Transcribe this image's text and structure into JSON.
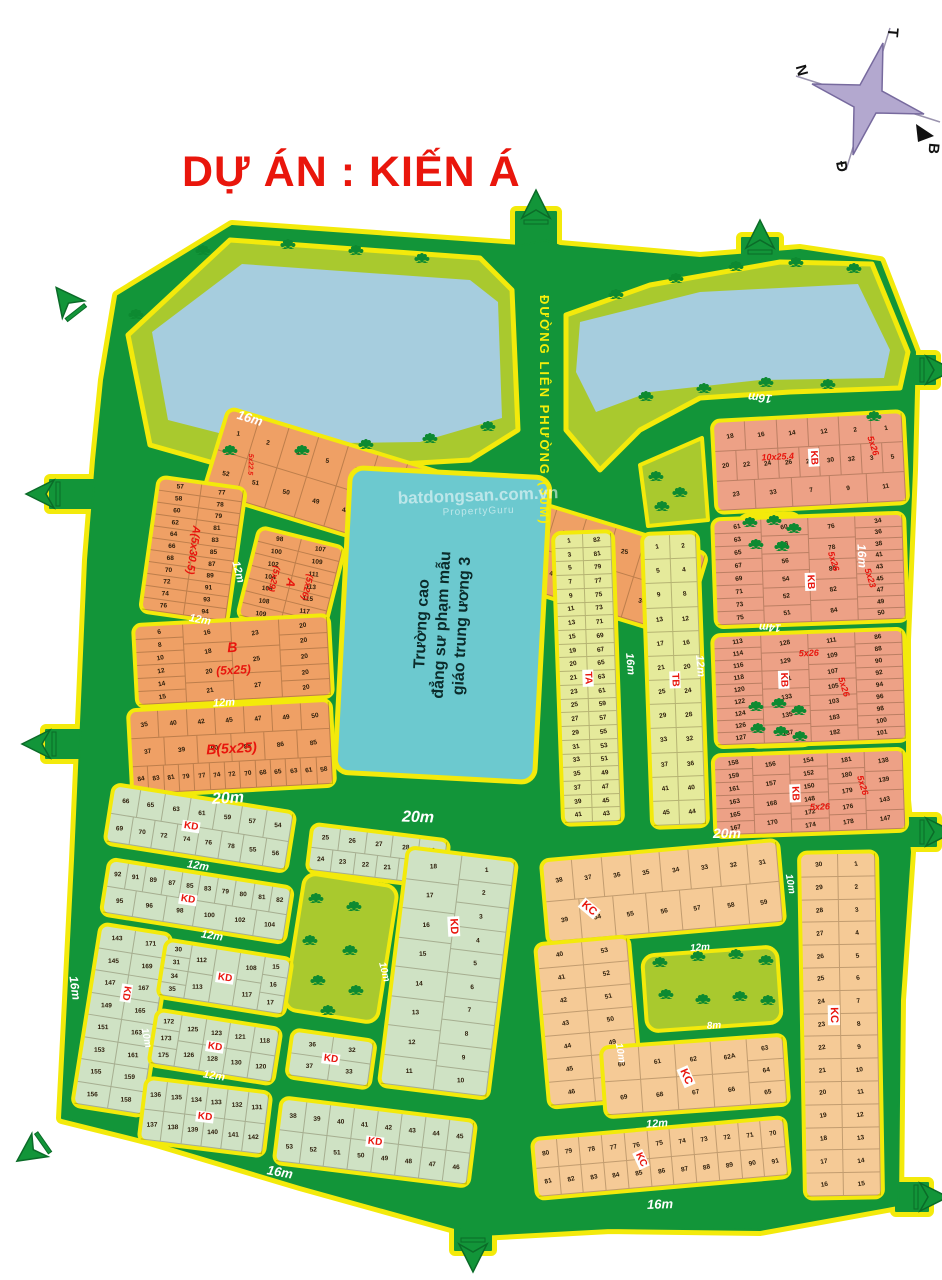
{
  "title": "DỰ ÁN : KIẾN Á",
  "compass": {
    "west": "T",
    "south": "N",
    "north": "B",
    "east": "Đ"
  },
  "main_road_label": "ĐƯỜNG LIÊN PHƯỜNG (30M)",
  "college": {
    "line1": "Trường cao",
    "line2": "đẳng sư phạm mẫu",
    "line3": "giáo trung ương 3"
  },
  "watermark": {
    "line1": "batdongsan.com.vn",
    "line2": "PropertyGuru"
  },
  "road_labels": [
    "16m",
    "16m",
    "12m",
    "12m",
    "12m",
    "20m",
    "20m",
    "20m",
    "16m",
    "16m",
    "14m",
    "12m",
    "16m",
    "12m",
    "12m",
    "12m",
    "10m",
    "10m",
    "16m",
    "16m",
    "12m",
    "8m",
    "10m",
    "12m",
    "16m",
    "10m"
  ],
  "blocks": {
    "a22": {
      "labels": [
        "A(5x22)",
        "5x22.5"
      ],
      "rows": [
        [
          "1",
          "2",
          "3",
          "5",
          "7",
          "9",
          "11",
          "13",
          "15",
          "17",
          "19",
          "21",
          "23",
          "25",
          "27",
          "29"
        ],
        [
          "52",
          "51",
          "50",
          "49",
          "48",
          "47",
          "46",
          "45",
          "44",
          "43",
          "42",
          "41",
          "33",
          "31",
          "30",
          "28"
        ]
      ]
    },
    "a30": {
      "labels": [
        "A(5x30.5)"
      ],
      "cols": [
        [
          "57",
          "58",
          "60",
          "62",
          "64",
          "66",
          "68",
          "70",
          "72",
          "74",
          "76"
        ],
        [
          "77",
          "78",
          "79",
          "81",
          "83",
          "85",
          "87",
          "89",
          "91",
          "93",
          "94"
        ]
      ]
    },
    "a29": {
      "labels": [
        "(5x29)",
        "A",
        "(5x26)"
      ],
      "cols": [
        [
          "98",
          "100",
          "102",
          "104",
          "106",
          "108",
          "109"
        ],
        [
          "107",
          "109",
          "111",
          "113",
          "115",
          "117",
          "118"
        ]
      ]
    },
    "b1": {
      "labels": [
        "B",
        "(5x25)"
      ],
      "cols": [
        [
          "6",
          "8",
          "10",
          "12",
          "14",
          "15"
        ],
        [
          "16",
          "18",
          "20",
          "21"
        ],
        [
          "23",
          "25",
          "27"
        ],
        [
          "20",
          "20",
          "20",
          "20",
          "20"
        ]
      ]
    },
    "b2": {
      "labels": [
        "B(5x25)"
      ],
      "rows": [
        [
          "35",
          "40",
          "42",
          "45",
          "47",
          "49",
          "50"
        ],
        [
          "37",
          "39",
          "90",
          "88",
          "86",
          "85"
        ],
        [
          "84",
          "83",
          "81",
          "79",
          "77",
          "74",
          "72",
          "70",
          "68",
          "65",
          "63",
          "61",
          "58"
        ]
      ]
    },
    "kd1": {
      "labels": [
        "KD"
      ],
      "rows": [
        [
          "66",
          "65",
          "63",
          "61",
          "59",
          "57",
          "54"
        ],
        [
          "69",
          "70",
          "72",
          "74",
          "76",
          "78",
          "55",
          "56"
        ]
      ]
    },
    "kd2": {
      "labels": [
        "KD"
      ],
      "rows": [
        [
          "92",
          "91",
          "89",
          "87",
          "85",
          "83",
          "79",
          "80",
          "81",
          "82"
        ],
        [
          "95",
          "96",
          "98",
          "100",
          "102",
          "104"
        ]
      ]
    },
    "kd3": {
      "labels": [
        "KD"
      ],
      "cols": [
        [
          "143",
          "145",
          "147",
          "149",
          "151",
          "153",
          "155",
          "156"
        ],
        [
          "171",
          "169",
          "167",
          "165",
          "163",
          "161",
          "159",
          "158"
        ]
      ]
    },
    "kd4": {
      "labels": [
        "KD"
      ],
      "cols": [
        [
          "30",
          "31",
          "34",
          "35"
        ],
        [
          "112",
          "113"
        ],
        [
          "115"
        ],
        [
          "108",
          "117"
        ],
        [
          "15",
          "16",
          "17"
        ]
      ]
    },
    "kd5": {
      "labels": [
        "KD"
      ],
      "cols": [
        [
          "172",
          "173",
          "175"
        ],
        [
          "125",
          "126"
        ],
        [
          "123",
          "128"
        ],
        [
          "121",
          "130"
        ],
        [
          "118",
          "120"
        ]
      ]
    },
    "kd6": {
      "labels": [
        "KD"
      ],
      "rows": [
        [
          "136",
          "135",
          "134",
          "133",
          "132",
          "131"
        ],
        [
          "137",
          "138",
          "139",
          "140",
          "141",
          "142"
        ]
      ]
    },
    "kdTop": {
      "labels": [],
      "rows": [
        [
          "25",
          "26",
          "27",
          "28",
          "29"
        ],
        [
          "24",
          "23",
          "22",
          "21",
          "20",
          "19"
        ]
      ]
    },
    "kdMain": {
      "labels": [
        "KD"
      ],
      "cols": [
        [
          "18",
          "17",
          "16",
          "15",
          "14",
          "13",
          "12",
          "11"
        ],
        [
          "1",
          "2",
          "3",
          "4",
          "5",
          "6",
          "7",
          "8",
          "9",
          "10"
        ]
      ]
    },
    "kd7": {
      "labels": [
        "KD"
      ],
      "rows": [
        [
          "36",
          "32"
        ],
        [
          "37",
          "33"
        ]
      ]
    },
    "kd8": {
      "labels": [
        "KD"
      ],
      "rows": [
        [
          "38",
          "39",
          "40",
          "41",
          "42",
          "43",
          "44",
          "45"
        ],
        [
          "53",
          "52",
          "51",
          "50",
          "49",
          "48",
          "47",
          "46"
        ]
      ]
    },
    "ta": {
      "labels": [
        "TA"
      ],
      "rows": [
        [
          "1",
          "82"
        ],
        [
          "3",
          "81"
        ],
        [
          "5",
          "79"
        ],
        [
          "7",
          "77"
        ],
        [
          "9",
          "75"
        ],
        [
          "11",
          "73"
        ],
        [
          "13",
          "71"
        ],
        [
          "15",
          "69"
        ],
        [
          "19",
          "67"
        ],
        [
          "20",
          "65"
        ],
        [
          "21",
          "63"
        ],
        [
          "23",
          "61"
        ],
        [
          "25",
          "59"
        ],
        [
          "27",
          "57"
        ],
        [
          "29",
          "55"
        ],
        [
          "31",
          "53"
        ],
        [
          "33",
          "51"
        ],
        [
          "35",
          "49"
        ],
        [
          "37",
          "47"
        ],
        [
          "39",
          "45"
        ],
        [
          "41",
          "43"
        ]
      ]
    },
    "tb": {
      "labels": [
        "TB"
      ],
      "rows": [
        [
          "1",
          "2"
        ],
        [
          "5",
          "4"
        ],
        [
          "9",
          "8"
        ],
        [
          "13",
          "12"
        ],
        [
          "17",
          "16"
        ],
        [
          "21",
          "20"
        ],
        [
          "25",
          "24"
        ],
        [
          "29",
          "28"
        ],
        [
          "33",
          "32"
        ],
        [
          "37",
          "36"
        ],
        [
          "41",
          "40"
        ],
        [
          "45",
          "44"
        ]
      ]
    },
    "kb1": {
      "labels": [
        "KB",
        "10x25.4",
        "5x26"
      ],
      "rows": [
        [
          "18",
          "16",
          "14",
          "12",
          "2",
          "1"
        ],
        [
          "20",
          "22",
          "24",
          "26",
          "28",
          "30",
          "32",
          "3",
          "5"
        ],
        [
          "23",
          "33",
          "7",
          "9",
          "11"
        ]
      ]
    },
    "kb2": {
      "labels": [
        "KB",
        "5x26",
        "5x23"
      ],
      "cols": [
        [
          "61",
          "63",
          "65",
          "67",
          "69",
          "71",
          "73",
          "75"
        ],
        [
          "60",
          "58",
          "56",
          "54",
          "52",
          "51"
        ],
        [
          "76",
          "78",
          "80",
          "82",
          "84"
        ],
        [
          "34",
          "36",
          "38",
          "41",
          "43",
          "45",
          "47",
          "49",
          "50"
        ]
      ]
    },
    "kb3": {
      "labels": [
        "KB",
        "5x26",
        "5x26"
      ],
      "cols": [
        [
          "113",
          "114",
          "116",
          "118",
          "120",
          "122",
          "124",
          "126",
          "127"
        ],
        [
          "128",
          "129",
          "131",
          "133",
          "135",
          "137"
        ],
        [
          "111",
          "109",
          "107",
          "105",
          "103",
          "183",
          "182"
        ],
        [
          "86",
          "88",
          "90",
          "92",
          "94",
          "96",
          "98",
          "100",
          "101"
        ]
      ]
    },
    "kb4": {
      "labels": [
        "KB",
        "5x26",
        "5x26"
      ],
      "cols": [
        [
          "158",
          "159",
          "161",
          "163",
          "165",
          "167"
        ],
        [
          "156",
          "157",
          "168",
          "170"
        ],
        [
          "154",
          "152",
          "150",
          "148",
          "172",
          "174"
        ],
        [
          "181",
          "180",
          "179",
          "176",
          "178"
        ],
        [
          "138",
          "139",
          "143",
          "147"
        ]
      ]
    },
    "kcTop": {
      "labels": [
        "KC"
      ],
      "rows": [
        [
          "38",
          "37",
          "36",
          "35",
          "34",
          "33",
          "32",
          "31"
        ],
        [
          "39",
          "54",
          "55",
          "56",
          "57",
          "58",
          "59"
        ]
      ]
    },
    "kcLeft": {
      "labels": [],
      "cols": [
        [
          "40",
          "41",
          "42",
          "43",
          "44",
          "45",
          "46"
        ],
        [
          "53",
          "52",
          "51",
          "50",
          "49",
          "48",
          "47"
        ]
      ]
    },
    "kcSmall": {
      "labels": [
        "KC"
      ],
      "cols": [
        [
          "60",
          "69"
        ],
        [
          "61",
          "68"
        ],
        [
          "62",
          "67"
        ],
        [
          "62A",
          "66"
        ],
        [
          "63",
          "64",
          "65"
        ]
      ]
    },
    "kcStrip": {
      "labels": [
        "KC"
      ],
      "rows": [
        [
          "80",
          "79",
          "78",
          "77",
          "76",
          "75",
          "74",
          "73",
          "72",
          "71",
          "70"
        ],
        [
          "81",
          "82",
          "83",
          "84",
          "85",
          "86",
          "87",
          "88",
          "89",
          "90",
          "91"
        ]
      ]
    },
    "kcRight": {
      "labels": [
        "KC"
      ],
      "rows": [
        [
          "30",
          "1"
        ],
        [
          "29",
          "2"
        ],
        [
          "28",
          "3"
        ],
        [
          "27",
          "4"
        ],
        [
          "26",
          "5"
        ],
        [
          "25",
          "6"
        ],
        [
          "24",
          "7"
        ],
        [
          "23",
          "8"
        ],
        [
          "22",
          "9"
        ],
        [
          "21",
          "10"
        ],
        [
          "20",
          "11"
        ],
        [
          "19",
          "12"
        ],
        [
          "18",
          "13"
        ],
        [
          "17",
          "14"
        ],
        [
          "16",
          "15"
        ]
      ]
    }
  },
  "colors": {
    "road": "#129539",
    "casing": "#f3ea0b",
    "park": "#a9c92e",
    "lake": "#a6cdde",
    "accent_red": "#e8150d"
  }
}
